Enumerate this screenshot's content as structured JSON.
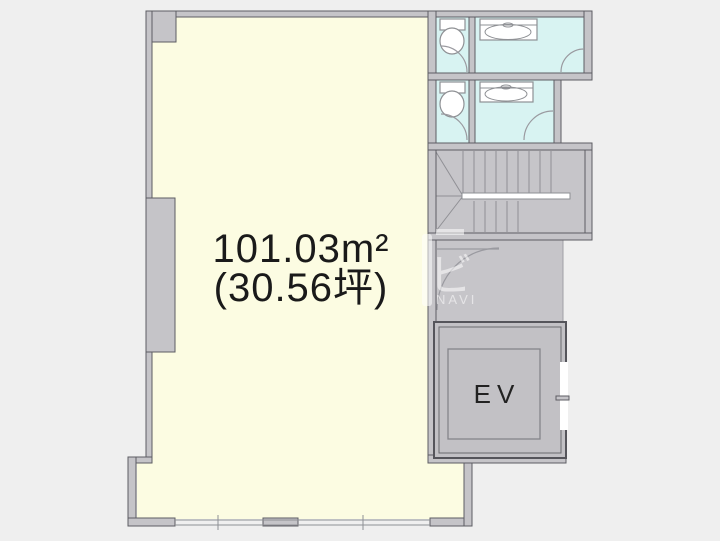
{
  "floorplan": {
    "labels": {
      "area_m2": "101.03m²",
      "area_tsubo": "(30.56坪)",
      "elevator": "EV"
    },
    "watermark": {
      "kana": "ビ",
      "latin": "NAVI"
    },
    "colors": {
      "background": "#efefef",
      "room_fill": "#fcfce2",
      "wet_area_fill": "#d8f3f2",
      "zone_fill": "#c6c5c9",
      "wall_fill": "#c5c4c8",
      "wall_stroke": "#5d5d63",
      "fixture_stroke": "#8e9094",
      "label_color": "#1a1a1a"
    },
    "icons": [
      "toilet-icon",
      "sink-counter-icon",
      "staircase-icon",
      "door-arc-icon",
      "elevator-icon",
      "window-icon"
    ]
  }
}
